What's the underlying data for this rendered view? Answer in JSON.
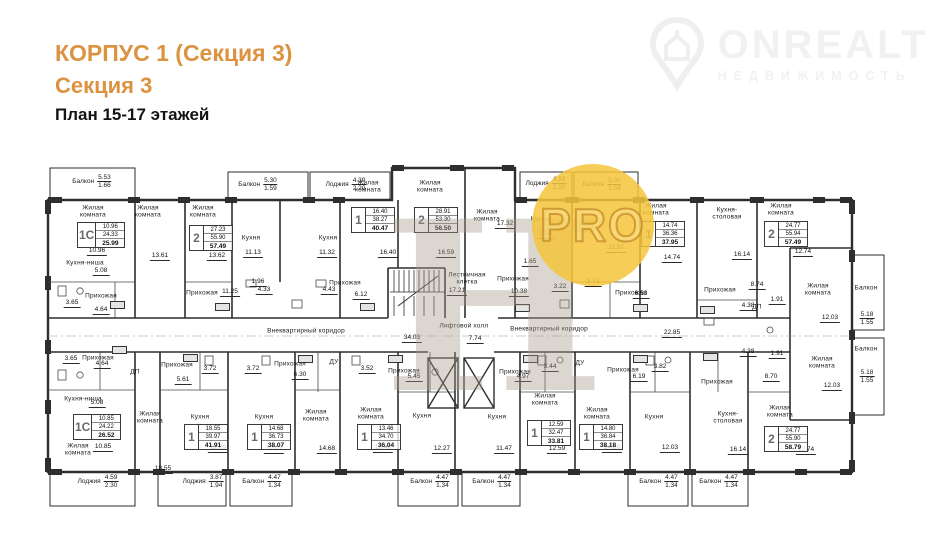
{
  "header": {
    "building_title": "КОРПУС 1 (Секция 3)",
    "section_title": "Секция 3",
    "plan_subtitle": "План 15-17 этажей",
    "accent_color": "#db9340"
  },
  "brand": {
    "name": "ONREALT",
    "tagline": "НЕДВИЖИМОСТЬ"
  },
  "watermarks": {
    "pro_badge": "PRO",
    "letter_mark": "Н"
  },
  "plan": {
    "line_color": "#2e2e2e",
    "room_labels": [
      {
        "t": "Жилая\nкомната",
        "x": 93,
        "y": 212
      },
      {
        "t": "Жилая\nкомната",
        "x": 148,
        "y": 212
      },
      {
        "t": "Жилая\nкомната",
        "x": 203,
        "y": 212
      },
      {
        "t": "Кухня",
        "x": 251,
        "y": 238
      },
      {
        "t": "Кухня",
        "x": 328,
        "y": 238
      },
      {
        "t": "Жилая\nкомната",
        "x": 368,
        "y": 187
      },
      {
        "t": "Жилая\nкомната",
        "x": 430,
        "y": 187
      },
      {
        "t": "Жилая\nкомната",
        "x": 487,
        "y": 216
      },
      {
        "t": "Кухня",
        "x": 540,
        "y": 219
      },
      {
        "t": "Жилая\nкомната",
        "x": 656,
        "y": 210
      },
      {
        "t": "Кухня-\nстоловая",
        "x": 727,
        "y": 214
      },
      {
        "t": "Жилая\nкомната",
        "x": 781,
        "y": 210
      },
      {
        "t": "Кухня-ниша",
        "x": 85,
        "y": 263
      },
      {
        "t": "Прихожая",
        "x": 101,
        "y": 296
      },
      {
        "t": "Прихожая",
        "x": 202,
        "y": 293
      },
      {
        "t": "Прихожая",
        "x": 345,
        "y": 283
      },
      {
        "t": "Прихожая",
        "x": 513,
        "y": 279
      },
      {
        "t": "Прихожая",
        "x": 631,
        "y": 293
      },
      {
        "t": "Прихожая",
        "x": 720,
        "y": 290
      },
      {
        "t": "Жилая\nкомната",
        "x": 818,
        "y": 290
      },
      {
        "t": "Лестничная\nклетка",
        "x": 467,
        "y": 279
      },
      {
        "t": "Лифтовой холл",
        "x": 464,
        "y": 326
      },
      {
        "t": "Внеквартирный коридор",
        "x": 306,
        "y": 331
      },
      {
        "t": "Внеквартирный коридор",
        "x": 549,
        "y": 329
      },
      {
        "t": "Балкон",
        "x": 866,
        "y": 288
      },
      {
        "t": "Балкон",
        "x": 866,
        "y": 349
      },
      {
        "t": "Прихожая",
        "x": 98,
        "y": 358
      },
      {
        "t": "Прихожая",
        "x": 177,
        "y": 365
      },
      {
        "t": "Прихожая",
        "x": 290,
        "y": 364
      },
      {
        "t": "Прихожая",
        "x": 404,
        "y": 371
      },
      {
        "t": "Прихожая",
        "x": 515,
        "y": 372
      },
      {
        "t": "Прихожая",
        "x": 623,
        "y": 370
      },
      {
        "t": "Прихожая",
        "x": 717,
        "y": 382
      },
      {
        "t": "Кухня-ниша",
        "x": 83,
        "y": 399
      },
      {
        "t": "Жилая\nкомната",
        "x": 78,
        "y": 450
      },
      {
        "t": "Жилая\nкомната",
        "x": 150,
        "y": 418
      },
      {
        "t": "Кухня",
        "x": 200,
        "y": 417
      },
      {
        "t": "Кухня",
        "x": 264,
        "y": 417
      },
      {
        "t": "Жилая\nкомната",
        "x": 316,
        "y": 416
      },
      {
        "t": "Жилая\nкомната",
        "x": 371,
        "y": 414
      },
      {
        "t": "Кухня",
        "x": 422,
        "y": 416
      },
      {
        "t": "Кухня",
        "x": 497,
        "y": 417
      },
      {
        "t": "Жилая\nкомната",
        "x": 545,
        "y": 400
      },
      {
        "t": "Жилая\nкомната",
        "x": 597,
        "y": 414
      },
      {
        "t": "Кухня",
        "x": 654,
        "y": 417
      },
      {
        "t": "Кухня-\nстоловая",
        "x": 728,
        "y": 418
      },
      {
        "t": "Жилая\nкомната",
        "x": 780,
        "y": 412
      },
      {
        "t": "Жилая\nкомната",
        "x": 822,
        "y": 363
      },
      {
        "t": "ДП",
        "x": 135,
        "y": 372
      },
      {
        "t": "ДУ",
        "x": 334,
        "y": 362
      },
      {
        "t": "ДУ",
        "x": 580,
        "y": 363
      },
      {
        "t": "ДП",
        "x": 757,
        "y": 307
      }
    ],
    "dimensions": [
      {
        "v": "10.96",
        "x": 97,
        "y": 256
      },
      {
        "v": "13.61",
        "x": 160,
        "y": 261
      },
      {
        "v": "13.62",
        "x": 217,
        "y": 261
      },
      {
        "v": "11.13",
        "x": 253,
        "y": 258
      },
      {
        "v": "11.32",
        "x": 327,
        "y": 258
      },
      {
        "v": "16.40",
        "x": 388,
        "y": 258
      },
      {
        "v": "16.59",
        "x": 446,
        "y": 258
      },
      {
        "v": "17.32",
        "x": 505,
        "y": 229
      },
      {
        "v": "9.54",
        "x": 546,
        "y": 239
      },
      {
        "v": "11.37",
        "x": 616,
        "y": 253
      },
      {
        "v": "14.74",
        "x": 672,
        "y": 263
      },
      {
        "v": "16.14",
        "x": 742,
        "y": 260
      },
      {
        "v": "12.74",
        "x": 803,
        "y": 257
      },
      {
        "v": "5.08",
        "x": 101,
        "y": 276
      },
      {
        "v": "1.96",
        "x": 258,
        "y": 287
      },
      {
        "v": "11.25",
        "x": 230,
        "y": 297
      },
      {
        "v": "3.65",
        "x": 72,
        "y": 308
      },
      {
        "v": "4.64",
        "x": 101,
        "y": 315
      },
      {
        "v": "4.33",
        "x": 264,
        "y": 295
      },
      {
        "v": "4.43",
        "x": 329,
        "y": 295
      },
      {
        "v": "6.12",
        "x": 361,
        "y": 300
      },
      {
        "v": "1.65",
        "x": 530,
        "y": 267
      },
      {
        "v": "3.22",
        "x": 560,
        "y": 292
      },
      {
        "v": "3.72",
        "x": 593,
        "y": 287
      },
      {
        "v": "10.38",
        "x": 519,
        "y": 297
      },
      {
        "v": "6.53",
        "x": 641,
        "y": 299
      },
      {
        "v": "8.74",
        "x": 757,
        "y": 290
      },
      {
        "v": "1.91",
        "x": 777,
        "y": 305
      },
      {
        "v": "4.38",
        "x": 748,
        "y": 311
      },
      {
        "v": "22.85",
        "x": 672,
        "y": 338
      },
      {
        "v": "12.03",
        "x": 830,
        "y": 323
      },
      {
        "v": "17.21",
        "x": 457,
        "y": 296
      },
      {
        "v": "34.03",
        "x": 412,
        "y": 343
      },
      {
        "v": "7.74",
        "x": 475,
        "y": 344
      },
      {
        "v": "3.72",
        "x": 210,
        "y": 374
      },
      {
        "v": "3.72",
        "x": 253,
        "y": 374
      },
      {
        "v": "5.61",
        "x": 183,
        "y": 385
      },
      {
        "v": "3.65",
        "x": 71,
        "y": 364
      },
      {
        "v": "4.64",
        "x": 102,
        "y": 369
      },
      {
        "v": "5.08",
        "x": 97,
        "y": 408
      },
      {
        "v": "10.85",
        "x": 103,
        "y": 452
      },
      {
        "v": "18.55",
        "x": 163,
        "y": 474
      },
      {
        "v": "12.09",
        "x": 218,
        "y": 453
      },
      {
        "v": "6.30",
        "x": 300,
        "y": 380
      },
      {
        "v": "3.52",
        "x": 367,
        "y": 374
      },
      {
        "v": "5.45",
        "x": 414,
        "y": 382
      },
      {
        "v": "12.03",
        "x": 274,
        "y": 454
      },
      {
        "v": "14.68",
        "x": 327,
        "y": 454
      },
      {
        "v": "13.46",
        "x": 383,
        "y": 453
      },
      {
        "v": "12.27",
        "x": 442,
        "y": 454
      },
      {
        "v": "4.97",
        "x": 523,
        "y": 382
      },
      {
        "v": "3.44",
        "x": 550,
        "y": 372
      },
      {
        "v": "6.19",
        "x": 639,
        "y": 382
      },
      {
        "v": "3.82",
        "x": 660,
        "y": 372
      },
      {
        "v": "11.47",
        "x": 504,
        "y": 454
      },
      {
        "v": "12.59",
        "x": 557,
        "y": 454
      },
      {
        "v": "14.80",
        "x": 612,
        "y": 453
      },
      {
        "v": "12.03",
        "x": 670,
        "y": 453
      },
      {
        "v": "8.70",
        "x": 771,
        "y": 382
      },
      {
        "v": "1.91",
        "x": 777,
        "y": 359
      },
      {
        "v": "4.38",
        "x": 748,
        "y": 357
      },
      {
        "v": "16.14",
        "x": 738,
        "y": 455
      },
      {
        "v": "12.74",
        "x": 806,
        "y": 455
      },
      {
        "v": "12.03",
        "x": 832,
        "y": 391
      }
    ],
    "balcony_labels": [
      {
        "n": "Балкон",
        "a": "5.53",
        "b": "1.66",
        "x": 92,
        "y": 182
      },
      {
        "n": "Балкон",
        "a": "5.30",
        "b": "1.59",
        "x": 258,
        "y": 185
      },
      {
        "n": "Лоджия",
        "a": "4.39",
        "b": "2.20",
        "x": 346,
        "y": 185
      },
      {
        "n": "Лоджия",
        "a": "4.39",
        "b": "2.20",
        "x": 546,
        "y": 184
      },
      {
        "n": "Балкон",
        "a": "5.30",
        "b": "1.59",
        "x": 602,
        "y": 185
      },
      {
        "n": "Лоджия",
        "a": "4.59",
        "b": "2.30",
        "x": 98,
        "y": 482
      },
      {
        "n": "Лоджия",
        "a": "3.87",
        "b": "1.94",
        "x": 203,
        "y": 482
      },
      {
        "n": "Балкон",
        "a": "4.47",
        "b": "1.34",
        "x": 262,
        "y": 482
      },
      {
        "n": "Балкон",
        "a": "4.47",
        "b": "1.34",
        "x": 430,
        "y": 482
      },
      {
        "n": "Балкон",
        "a": "4.47",
        "b": "1.34",
        "x": 492,
        "y": 482
      },
      {
        "n": "Балкон",
        "a": "4.47",
        "b": "1.34",
        "x": 659,
        "y": 482
      },
      {
        "n": "Балкон",
        "a": "4.47",
        "b": "1.34",
        "x": 719,
        "y": 482
      },
      {
        "n": "",
        "a": "5.18",
        "b": "1.55",
        "x": 867,
        "y": 319
      },
      {
        "n": "",
        "a": "5.18",
        "b": "1.55",
        "x": 867,
        "y": 377
      }
    ],
    "apartment_specs": [
      {
        "n": "1С",
        "v": [
          "10.96",
          "24.33",
          "25.99"
        ],
        "x": 77,
        "y": 222
      },
      {
        "n": "2",
        "v": [
          "27.23",
          "55.90",
          "57.49"
        ],
        "x": 189,
        "y": 225
      },
      {
        "n": "1",
        "v": [
          "16.40",
          "38.27",
          "40.47"
        ],
        "x": 351,
        "y": 207
      },
      {
        "n": "2",
        "v": [
          "28.91",
          "53.30",
          "56.50"
        ],
        "x": 414,
        "y": 207
      },
      {
        "n": "1",
        "v": [
          "14.74",
          "36.36",
          "37.95"
        ],
        "x": 641,
        "y": 221
      },
      {
        "n": "2",
        "v": [
          "24.77",
          "55.94",
          "57.49"
        ],
        "x": 764,
        "y": 221
      },
      {
        "n": "1С",
        "v": [
          "10.85",
          "24.22",
          "26.52"
        ],
        "x": 73,
        "y": 414
      },
      {
        "n": "1",
        "v": [
          "18.55",
          "39.97",
          "41.91"
        ],
        "x": 184,
        "y": 424
      },
      {
        "n": "1",
        "v": [
          "14.68",
          "36.73",
          "38.07"
        ],
        "x": 247,
        "y": 424
      },
      {
        "n": "1",
        "v": [
          "13.46",
          "34.70",
          "36.04"
        ],
        "x": 357,
        "y": 424
      },
      {
        "n": "1",
        "v": [
          "12.59",
          "32.47",
          "33.81"
        ],
        "x": 527,
        "y": 420
      },
      {
        "n": "1",
        "v": [
          "14.80",
          "36.84",
          "38.18"
        ],
        "x": 579,
        "y": 424
      },
      {
        "n": "2",
        "v": [
          "24.77",
          "55.90",
          "58.79"
        ],
        "x": 764,
        "y": 426
      }
    ],
    "apt_number_tags": [
      {
        "x": 110,
        "y": 301
      },
      {
        "x": 215,
        "y": 303
      },
      {
        "x": 360,
        "y": 303
      },
      {
        "x": 515,
        "y": 304
      },
      {
        "x": 633,
        "y": 304
      },
      {
        "x": 700,
        "y": 306
      },
      {
        "x": 112,
        "y": 346
      },
      {
        "x": 183,
        "y": 354
      },
      {
        "x": 298,
        "y": 355
      },
      {
        "x": 388,
        "y": 355
      },
      {
        "x": 523,
        "y": 355
      },
      {
        "x": 633,
        "y": 355
      },
      {
        "x": 703,
        "y": 353
      }
    ]
  }
}
